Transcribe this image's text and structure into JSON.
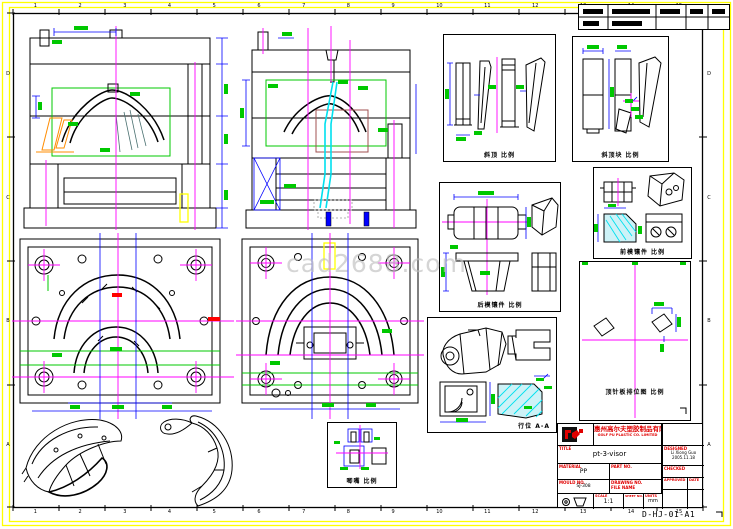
{
  "sheet": {
    "watermark": "cad2688.com",
    "drawing_code": "D-HJ-01-A1",
    "zones_top": [
      "1",
      "2",
      "3",
      "4",
      "5",
      "6",
      "7",
      "8",
      "9",
      "10",
      "11",
      "12",
      "13",
      "14",
      "15"
    ],
    "zones_bottom": [
      "1",
      "2",
      "3",
      "4",
      "5",
      "6",
      "7",
      "8",
      "9",
      "10",
      "11",
      "12",
      "13",
      "14",
      "15"
    ],
    "zones_left": [
      "D",
      "C",
      "B",
      "A"
    ],
    "zones_right": [
      "D",
      "C",
      "B",
      "A"
    ],
    "colors": {
      "frame": "#ffff00",
      "dimension": "#0000ff",
      "dim_text": "#00c800",
      "centerline": "#ff00ff",
      "highlight": "#00e0ee",
      "lifter": "#ff8c00",
      "callout": "#ff0000",
      "title_text": "#e00000",
      "watermark_gray": "#bfbfbf"
    }
  },
  "details": {
    "lifter_label": "斜顶 比例",
    "lifter_block_label": "斜顶块 比例",
    "core_insert_label": "后模镶件 比例",
    "cavity_insert_label": "前模镶件 比例",
    "ejector_plate_label": "顶针板排位图 比例",
    "slider_label": "行位 A-A",
    "sprue_label": "唧嘴 比例"
  },
  "title_block": {
    "company_cn": "惠州高尔夫塑胶制品有限公司",
    "company_en": "GOLF PU PLASTIC CO. LIMITED",
    "labels": {
      "title": "TITLE",
      "material": "MATERIAL",
      "part_no": "PART NO.",
      "mould_no": "MOULD NO.",
      "drawing_no": "DRAWING NO.",
      "file_name": "FILE NAME",
      "scale": "SCALE",
      "sheet_no": "SHEET NO.",
      "units": "UNITS",
      "designed": "DESIGNED",
      "checked": "CHECKED",
      "approved": "APPROVED",
      "date": "DATE"
    },
    "values": {
      "title": "pt-3-visor",
      "material": "PP",
      "mould_no": "SJ-308",
      "scale": "1:1",
      "units": "mm",
      "designed_name": "Li Xiong Guo",
      "designed_date": "2005.11.18"
    }
  }
}
